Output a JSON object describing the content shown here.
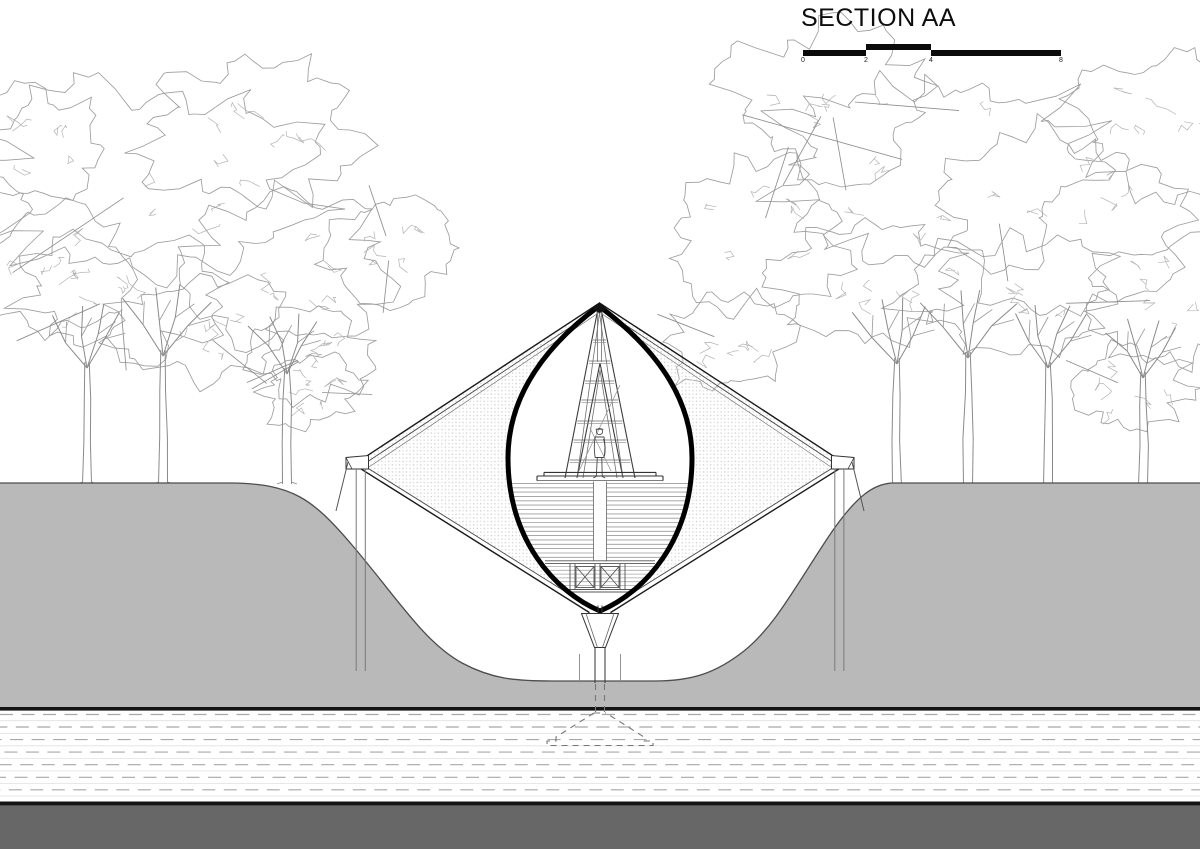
{
  "title": {
    "label": "SECTION AA"
  },
  "scale_bar": {
    "ticks": [
      "0",
      "2",
      "4",
      "8"
    ]
  },
  "colors": {
    "ground": "#b9b9b9",
    "substrate_strip": "#676767",
    "line": "#111111",
    "tree_line": "#9d9d9d",
    "hatch_dash": "#a8a8a8"
  },
  "elements": [
    "trees",
    "tent-pavilion",
    "lens-opening",
    "a-frame",
    "human-figure",
    "deck-platform",
    "ground-berm",
    "substrate-hatch",
    "foundation-dashed"
  ],
  "scene": {
    "trees_left": {
      "trunks": [
        {
          "x": 87,
          "base": 484,
          "top": 362
        },
        {
          "x": 163,
          "base": 484,
          "top": 350
        },
        {
          "x": 287,
          "base": 484,
          "top": 368
        }
      ],
      "canopies": [
        [
          150,
          180,
          160,
          95
        ],
        [
          50,
          270,
          75,
          60
        ],
        [
          250,
          130,
          105,
          70
        ],
        [
          285,
          270,
          95,
          70
        ],
        [
          120,
          295,
          100,
          58
        ],
        [
          310,
          355,
          55,
          45
        ],
        [
          35,
          145,
          65,
          55
        ],
        [
          390,
          248,
          62,
          50
        ],
        [
          200,
          330,
          90,
          50
        ],
        [
          310,
          392,
          48,
          36
        ]
      ]
    },
    "trees_right": {
      "trunks": [
        {
          "x": 897,
          "base": 486,
          "top": 358
        },
        {
          "x": 968,
          "base": 486,
          "top": 352
        },
        {
          "x": 1048,
          "base": 486,
          "top": 362
        },
        {
          "x": 1143,
          "base": 485,
          "top": 372
        }
      ],
      "canopies": [
        [
          940,
          170,
          170,
          95
        ],
        [
          830,
          100,
          100,
          70
        ],
        [
          760,
          235,
          85,
          70
        ],
        [
          728,
          342,
          60,
          50
        ],
        [
          1060,
          220,
          115,
          85
        ],
        [
          1160,
          125,
          85,
          70
        ],
        [
          1170,
          300,
          80,
          60
        ],
        [
          870,
          280,
          95,
          60
        ],
        [
          1010,
          295,
          105,
          55
        ],
        [
          1130,
          388,
          58,
          40
        ]
      ]
    },
    "hatch": {
      "top": 711,
      "bottom": 801,
      "rows": 7
    }
  }
}
